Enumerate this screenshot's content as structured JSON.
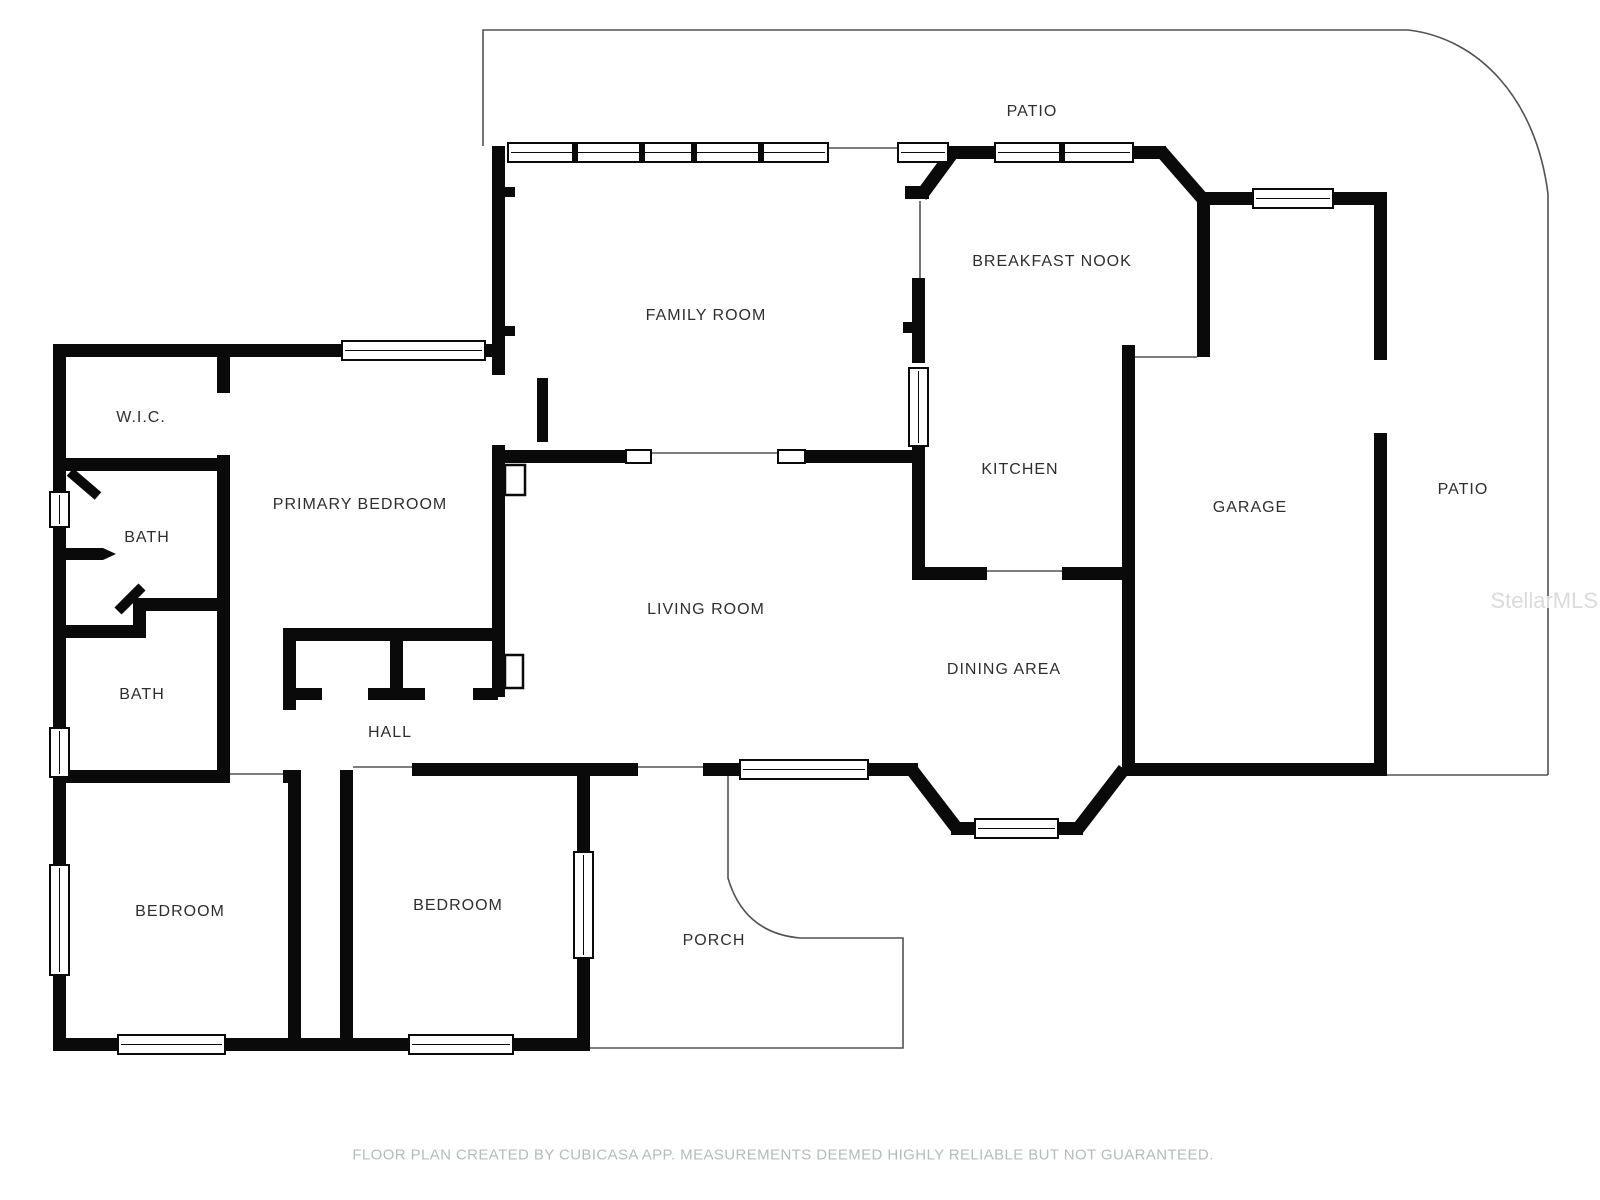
{
  "plan": {
    "rooms": [
      {
        "name": "patio-top",
        "label": "PATIO"
      },
      {
        "name": "family-room",
        "label": "FAMILY ROOM"
      },
      {
        "name": "breakfast-nook",
        "label": "BREAKFAST NOOK"
      },
      {
        "name": "wic",
        "label": "W.I.C."
      },
      {
        "name": "primary-bedroom",
        "label": "PRIMARY BEDROOM"
      },
      {
        "name": "bath-1",
        "label": "BATH"
      },
      {
        "name": "kitchen",
        "label": "KITCHEN"
      },
      {
        "name": "garage",
        "label": "GARAGE"
      },
      {
        "name": "patio-right",
        "label": "PATIO"
      },
      {
        "name": "bath-2",
        "label": "BATH"
      },
      {
        "name": "living-room",
        "label": "LIVING ROOM"
      },
      {
        "name": "dining-area",
        "label": "DINING AREA"
      },
      {
        "name": "hall",
        "label": "HALL"
      },
      {
        "name": "bedroom-1",
        "label": "BEDROOM"
      },
      {
        "name": "bedroom-2",
        "label": "BEDROOM"
      },
      {
        "name": "porch",
        "label": "PORCH"
      }
    ],
    "footer_disclaimer": "FLOOR PLAN CREATED BY CUBICASA APP. MEASUREMENTS DEEMED HIGHLY RELIABLE BUT NOT GUARANTEED.",
    "watermark": "StellarMLS",
    "colors": {
      "wall": "#0a0a0a",
      "outline": "#525252",
      "label": "#2e2e2e",
      "footer_text": "#b6babd",
      "watermark_text": "#dbdbdb",
      "background": "#ffffff"
    }
  }
}
